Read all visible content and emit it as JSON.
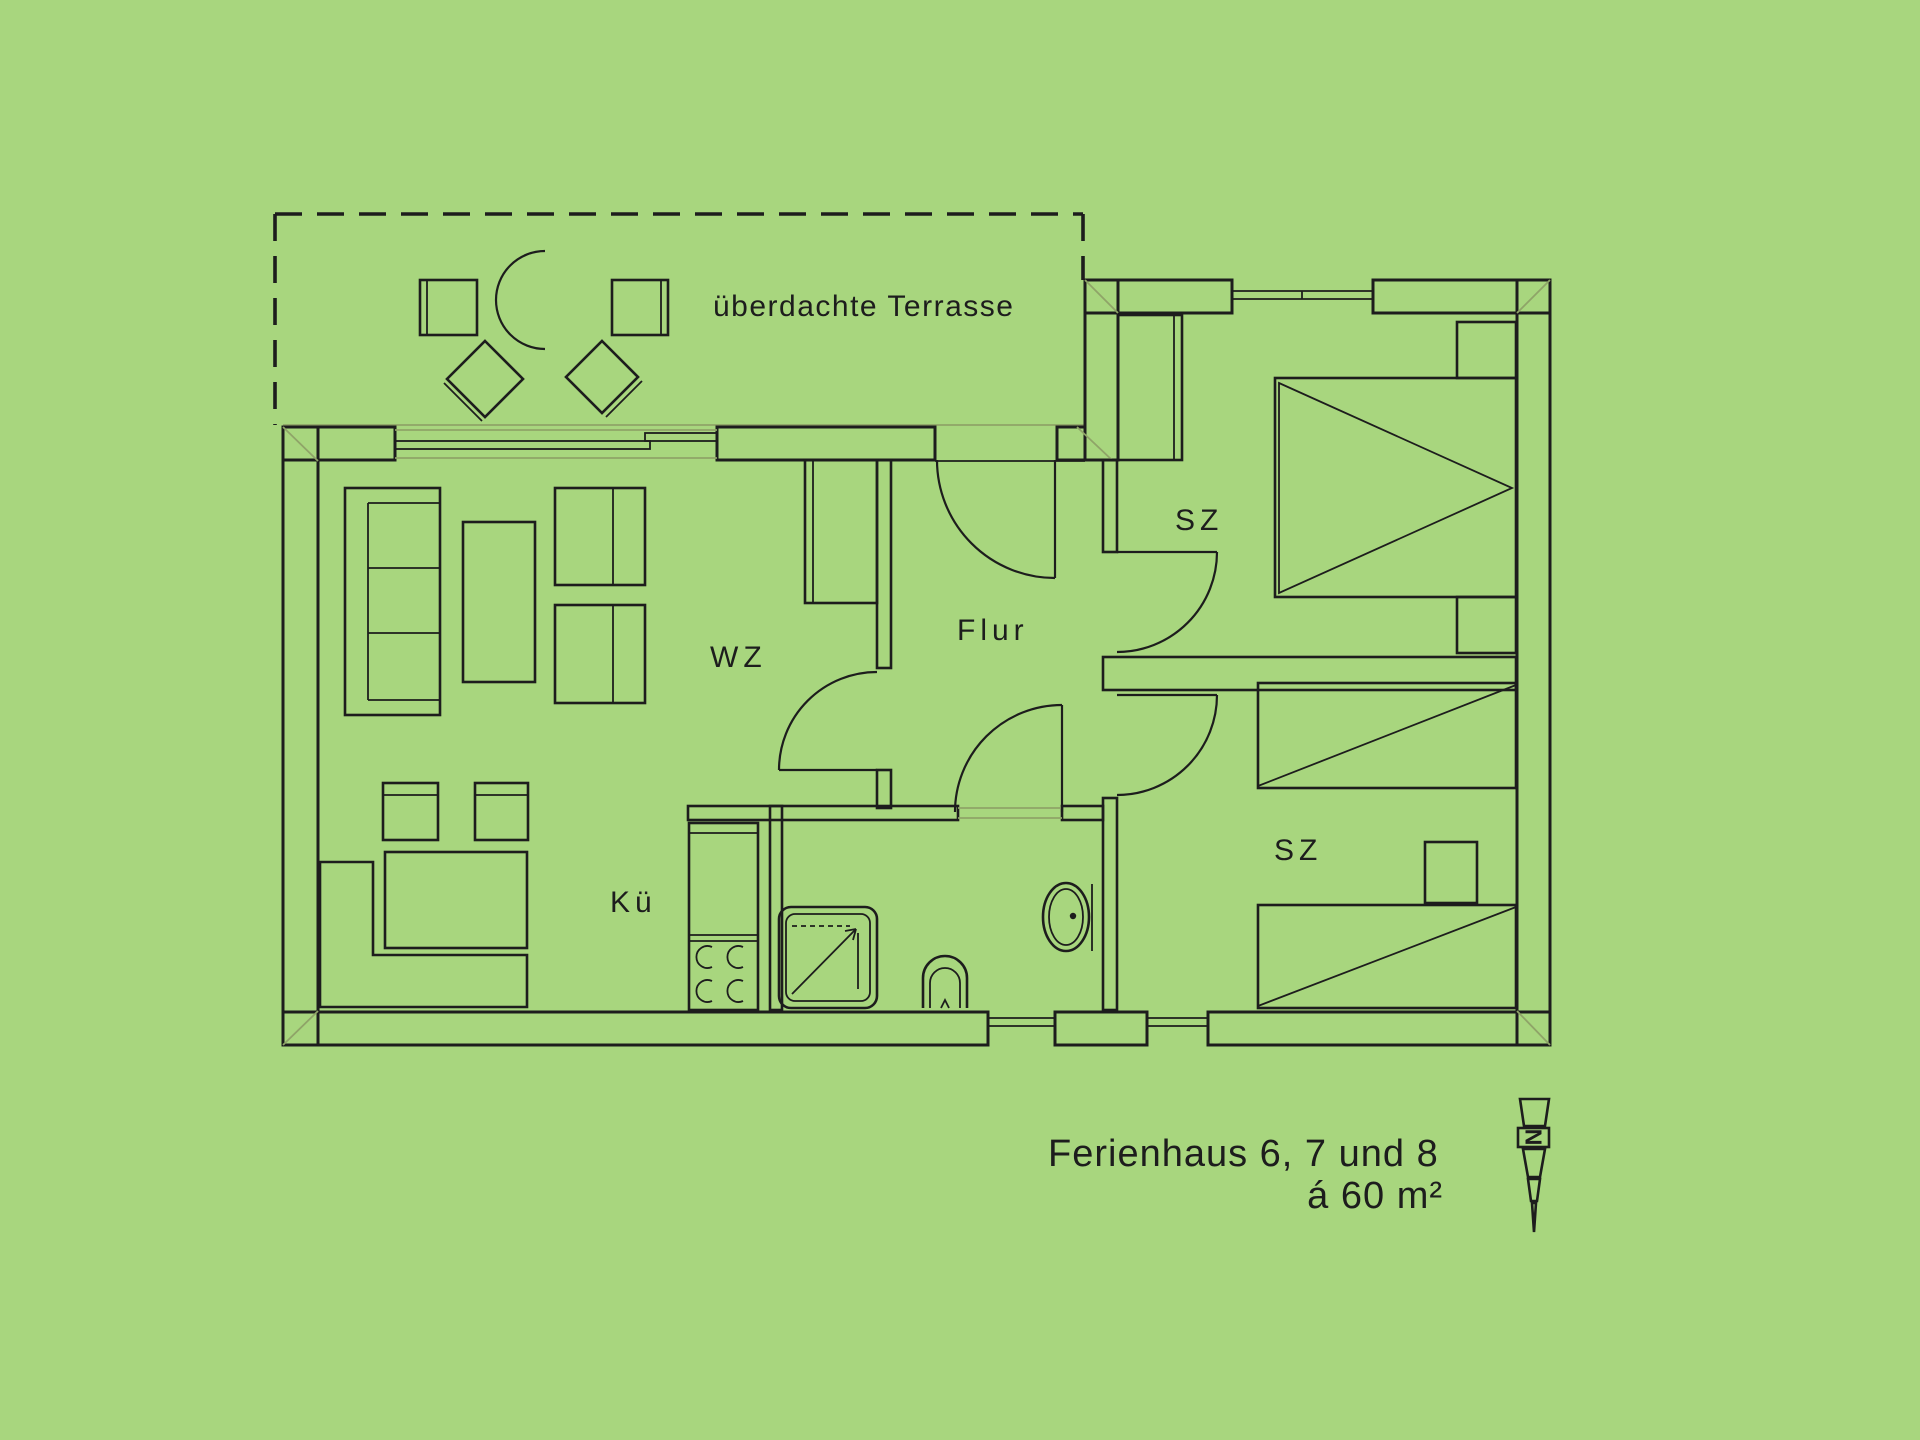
{
  "colors": {
    "background": "#a8d67e",
    "line": "#1d1d1d",
    "muted": "#8fa468"
  },
  "terrace": {
    "label": "überdachte Terrasse"
  },
  "rooms": {
    "living": {
      "label": "WZ"
    },
    "hall": {
      "label": "Flur"
    },
    "kitchen": {
      "label": "Kü"
    },
    "bedroom_top": {
      "label": "SZ"
    },
    "bedroom_bottom": {
      "label": "SZ"
    }
  },
  "caption": {
    "line1": "Ferienhaus  6, 7 und 8",
    "line2": "á 60 m²"
  },
  "north_indicator": {
    "label": "N"
  }
}
